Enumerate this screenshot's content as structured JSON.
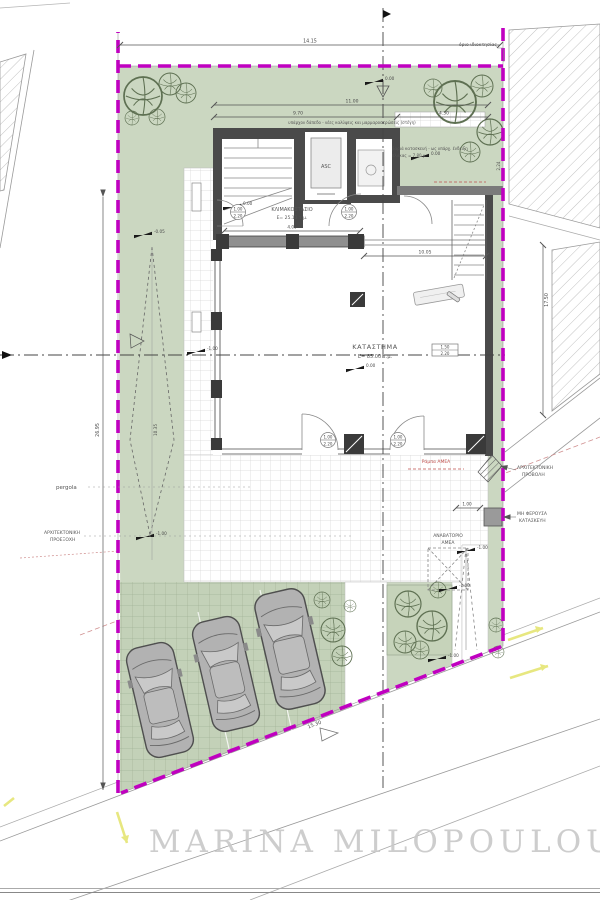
{
  "watermark": "MARINA MILOPOULOU",
  "rooms": {
    "stair_hall_name": "ΚΛΙΜΑΚΟΣΤΑΣΙΟ",
    "stair_hall_area": "E= 25.13 τ.μ.",
    "elevator": "ASC",
    "shop_name": "ΚΑΤΑΣΤΗΜΑ",
    "shop_area": "E= 85.00 τ.μ.",
    "lift_line1": "ΑΝΑΒΑΤΟΡΙΟ",
    "lift_line2": "ΑΜΕΑ"
  },
  "labels": {
    "pergola": "pergola",
    "arch_left1": "ΑΡΧΙΤΕΚΤΟΝΙΚΗ",
    "arch_left2": "ΠΡΟΕΞΟΧΗ",
    "arch_right1": "ΑΡΧΙΤΕΚΤΟΝΙΚΗ",
    "arch_right2": "ΠΡΟΒΟΛΗ",
    "nonbearing1": "ΜΗ ΦΕΡΟΥΣΑ",
    "nonbearing2": "ΚΑΤΑΣΚΕΥΗ",
    "boundary": "όριο ιδιοκτησίας",
    "ramp": "Ράμπα ΑΜΕΑ",
    "note_top": "υπάρχον δάπεδο - νέες καλύψεις και μαρμαροστρώσεις (στέγη)",
    "note_right1": "βαριά κατασκευή - ως υπάρχ. ένδειξη",
    "note_right2": "πλάκας = 7.80 μ."
  },
  "dims": {
    "top": "14.15",
    "w11": "11.00",
    "w97": "9.70",
    "w43": "4.30",
    "lobby": "4.00",
    "shopfront": "10.05",
    "left": "26.95",
    "cone": "10.35",
    "bottom": "15.30",
    "right": "17.50",
    "walk": "1.00",
    "shaft": "2.24"
  },
  "levels": {
    "zero": "0.00",
    "m005": "-0.05",
    "m100": "-1.00"
  },
  "tags": {
    "door_w": "1.00",
    "door_h": "2.20",
    "win_w": "1.50",
    "win_h": "2.20"
  },
  "colors": {
    "boundary": "#c000c0",
    "green": "#cbd7c1",
    "wall": "#4a4a4a",
    "accent_red": "#c0504d",
    "road_yellow": "#e3e36a",
    "watermark_gray": "#c9c9c9"
  }
}
